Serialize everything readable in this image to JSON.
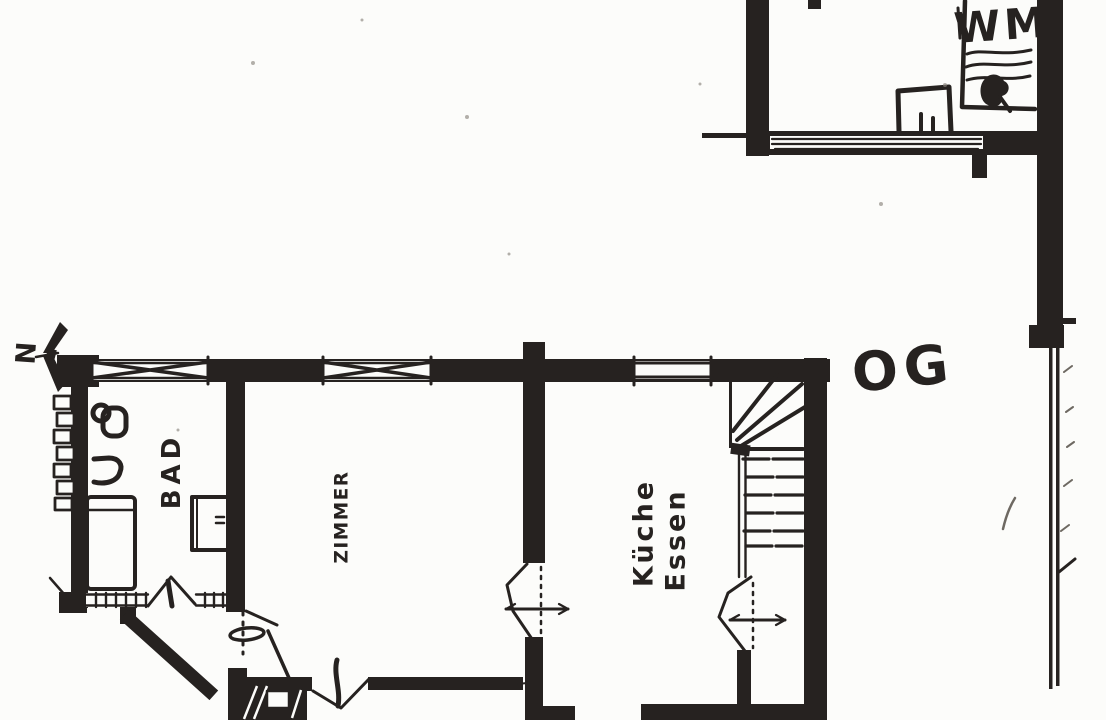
{
  "palette": {
    "ink": "#262220",
    "ink_soft": "#4a443e",
    "paper": "#fcfcfa"
  },
  "plan": {
    "floor_label": "OG",
    "north_label": "N",
    "rooms": {
      "bathroom": {
        "label": "BAD"
      },
      "room": {
        "label": "ZIMMER"
      },
      "kitchen": {
        "label_line1": "Küche",
        "label_line2": "Essen"
      },
      "laundry": {
        "appliance_label": "WM"
      }
    }
  }
}
